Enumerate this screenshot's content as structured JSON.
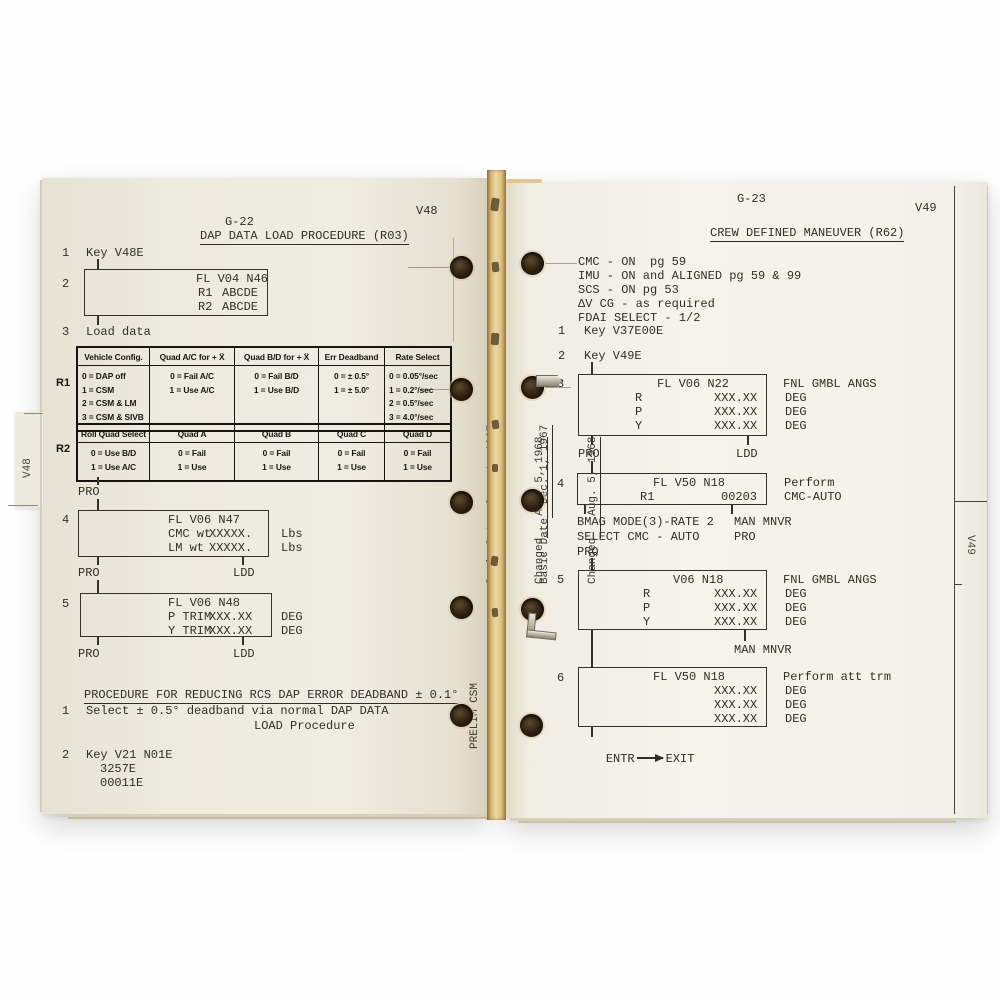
{
  "colors": {
    "ink": "#322e27",
    "paper_left": "#efece2",
    "paper_right": "#f5f3eb",
    "page_edge_tan": "#d7b471",
    "table_ink": "#17150f"
  },
  "left_page": {
    "folio": "G-22",
    "corner_tab": "V48",
    "edge_tab": "V48",
    "title": "DAP DATA LOAD PROCEDURE (R03)",
    "s1_num": "1",
    "s1_text": "Key V48E",
    "s2_num": "2",
    "box2": {
      "title": "FL V04 N46",
      "rows": [
        {
          "label": "R1",
          "value": "ABCDE"
        },
        {
          "label": "R2",
          "value": "ABCDE"
        }
      ]
    },
    "s3_num": "3",
    "s3_text": "Load data",
    "table_r1": {
      "row_label": "R1",
      "headers": [
        "Vehicle Config.",
        "Quad A/C for + Ẍ",
        "Quad B/D for + Ẍ",
        "Err Deadband",
        "Rate Select"
      ],
      "col1": [
        "0 = DAP off",
        "1 = CSM",
        "2 = CSM & LM",
        "3 = CSM & SIVB"
      ],
      "col2": [
        "0 = Fail A/C",
        "1 = Use A/C"
      ],
      "col3": [
        "0 = Fail B/D",
        "1 = Use B/D"
      ],
      "col4": [
        "0 = ± 0.5°",
        "1 = ± 5.0°"
      ],
      "col5": [
        "0 = 0.05°/sec",
        "1 = 0.2°/sec",
        "2 = 0.5°/sec",
        "3 = 4.0°/sec"
      ]
    },
    "table_r2": {
      "row_label": "R2",
      "headers": [
        "Roll Quad Select",
        "Quad A",
        "Quad B",
        "Quad C",
        "Quad D"
      ],
      "col1": [
        "0 = Use B/D",
        "1 = Use A/C"
      ],
      "col2": [
        "0 = Fail",
        "1 = Use"
      ],
      "col3": [
        "0 = Fail",
        "1 = Use"
      ],
      "col4": [
        "0 = Fail",
        "1 = Use"
      ],
      "col5": [
        "0 = Fail",
        "1 = Use"
      ]
    },
    "pro_after_table": "PRO",
    "s4_num": "4",
    "box4": {
      "title": "FL V06 N47",
      "rows": [
        {
          "label": "CMC wt",
          "value": "XXXXX.",
          "unit": "Lbs"
        },
        {
          "label": "LM wt",
          "value": "XXXXX.",
          "unit": "Lbs"
        }
      ],
      "pro": "PRO",
      "ldd": "LDD"
    },
    "s5_num": "5",
    "box5": {
      "title": "FL V06 N48",
      "rows": [
        {
          "label": "P TRIM",
          "value": "XXX.XX",
          "unit": "DEG"
        },
        {
          "label": "Y TRIM",
          "value": "XXX.XX",
          "unit": "DEG"
        }
      ],
      "pro": "PRO",
      "ldd": "LDD"
    },
    "sub_procedure": {
      "title": "PROCEDURE FOR REDUCING RCS DAP ERROR DEADBAND ± 0.1°",
      "s1_num": "1",
      "s1_line1": "Select ± 0.5° deadband via normal DAP DATA",
      "s1_line2": "LOAD Procedure",
      "s2_num": "2",
      "s2_line1": "Key V21 N01E",
      "s2_line2": "3257E",
      "s2_line3": "00011E"
    },
    "gutter": {
      "basic_date_label": "Basic Date",
      "basic_date_value": "Dec. 1, 1967",
      "changed_label": "Changed",
      "changed_value": "Aug. 5, 1968",
      "prelim": "PRELIM CSM"
    }
  },
  "right_page": {
    "folio": "G-23",
    "corner_tab": "V49",
    "edge_tab": "V49",
    "title": "CREW DEFINED MANEUVER (R62)",
    "config_list": [
      "CMC - ON  pg 59",
      "IMU - ON and ALIGNED pg 59 & 99",
      "SCS - ON pg 53",
      "ΔV CG - as required",
      "FDAI SELECT - 1/2"
    ],
    "s1_num": "1",
    "s1_text": "Key V37E00E",
    "s2_num": "2",
    "s2_text": "Key V49E",
    "s3_num": "3",
    "box3": {
      "title": "FL V06 N22",
      "note": "FNL GMBL ANGS",
      "rows": [
        {
          "label": "R",
          "value": "XXX.XX",
          "unit": "DEG"
        },
        {
          "label": "P",
          "value": "XXX.XX",
          "unit": "DEG"
        },
        {
          "label": "Y",
          "value": "XXX.XX",
          "unit": "DEG"
        }
      ],
      "pro": "PRO",
      "ldd": "LDD"
    },
    "s4_num": "4",
    "box4": {
      "title": "FL V50 N18",
      "note1": "Perform",
      "note2": "CMC-AUTO",
      "rows": [
        {
          "label": "R1",
          "value": "00203"
        }
      ]
    },
    "below4_l1": "BMAG MODE(3)-RATE 2",
    "below4_l2": "SELECT CMC - AUTO",
    "below4_l3": "PRO",
    "below4_r1": "MAN MNVR",
    "below4_r2": "PRO",
    "s5_num": "5",
    "box5": {
      "title": "V06 N18",
      "note": "FNL GMBL ANGS",
      "rows": [
        {
          "label": "R",
          "value": "XXX.XX",
          "unit": "DEG"
        },
        {
          "label": "P",
          "value": "XXX.XX",
          "unit": "DEG"
        },
        {
          "label": "Y",
          "value": "XXX.XX",
          "unit": "DEG"
        }
      ],
      "below": "MAN MNVR"
    },
    "s6_num": "6",
    "box6": {
      "title": "FL V50 N18",
      "note": "Perform att trm",
      "rows": [
        {
          "value": "XXX.XX",
          "unit": "DEG"
        },
        {
          "value": "XXX.XX",
          "unit": "DEG"
        },
        {
          "value": "XXX.XX",
          "unit": "DEG"
        }
      ],
      "entr": "ENTR",
      "exit": "EXIT"
    },
    "gutter": {
      "basic_date_label": "Basic Date",
      "basic_date_value": "Dec. 1, 1967",
      "changed_label": "Changed",
      "changed_value": "Aug. 5, 1968",
      "prelim": "PRELIM CSM"
    }
  }
}
